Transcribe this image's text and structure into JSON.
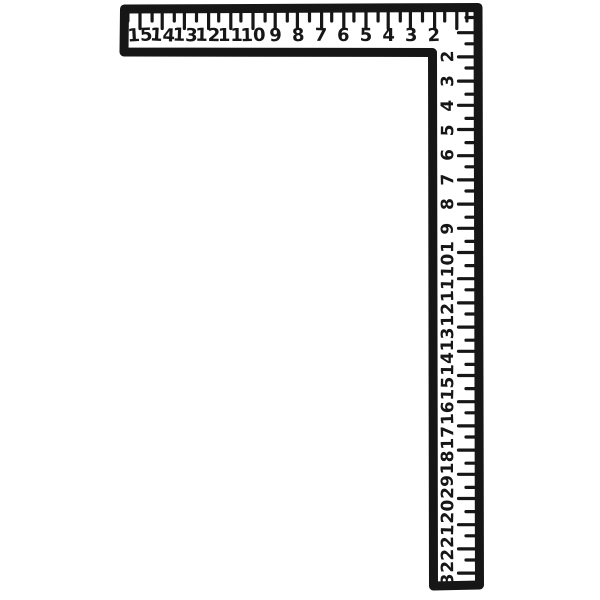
{
  "figure": {
    "name": "carpenter-framing-square",
    "description": "L-shaped framing square ruler drawn in black ink on white",
    "background_color": "#ffffff",
    "ink_color": "#161616",
    "horizontal_arm": {
      "unit_numbers": [
        "15",
        "14",
        "13",
        "12",
        "11",
        "10",
        "9",
        "8",
        "7",
        "6",
        "5",
        "4",
        "3",
        "2"
      ]
    },
    "vertical_arm": {
      "unit_numbers": [
        "2",
        "3",
        "4",
        "5",
        "6",
        "7",
        "8",
        "9",
        "10",
        "11",
        "12",
        "13",
        "14",
        "15",
        "16",
        "17",
        "18",
        "19",
        "20",
        "21",
        "22",
        "23"
      ]
    }
  }
}
